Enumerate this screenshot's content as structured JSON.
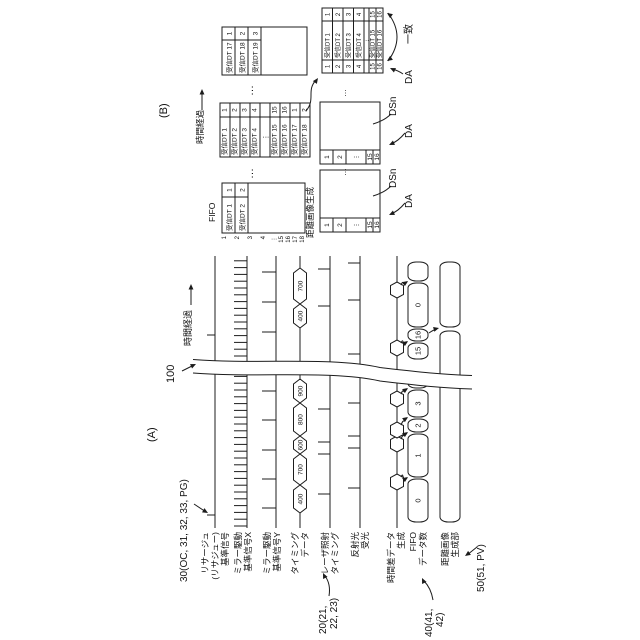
{
  "figure": {
    "label_a": "(A)",
    "label_b": "(B)",
    "ref_100": "100",
    "ref_30": "30(OC, 31, 32, 33, PG)",
    "ref_20_l1": "20(21,",
    "ref_20_l2": "22, 23)",
    "ref_40_l1": "40(41,",
    "ref_40_l2": "42)",
    "ref_50": "50(51, PV)",
    "time_elapsed_a": "時間経過",
    "time_elapsed_b": "時間経過"
  },
  "signal_labels": {
    "rows": [
      {
        "id": "lissajous",
        "lines": [
          "リサージュ",
          "(リサジュー)",
          "基準信号"
        ]
      },
      {
        "id": "mirror-x",
        "lines": [
          "ミラー駆動",
          "基準信号X"
        ]
      },
      {
        "id": "mirror-y",
        "lines": [
          "ミラー駆動",
          "基準信号Y"
        ]
      },
      {
        "id": "timing-data",
        "lines": [
          "タイミング",
          "データ"
        ]
      },
      {
        "id": "laser",
        "lines": [
          "レーザ照射",
          "タイミング"
        ]
      },
      {
        "id": "reflect",
        "lines": [
          "反射光",
          "受光"
        ]
      },
      {
        "id": "diff-gen",
        "lines": [
          "時間差データ",
          "生成"
        ]
      },
      {
        "id": "fifo-count",
        "lines": [
          "FIFO",
          "データ数"
        ]
      },
      {
        "id": "range-image",
        "lines": [
          "距離画像",
          "生成部"
        ]
      }
    ]
  },
  "waveforms": {
    "x_start": 112,
    "x_end": 384,
    "lissajous_y": 215,
    "lissajous_ticks": [
      125,
      305
    ],
    "mirror_x_y": 247,
    "mirror_x_comb": {
      "from": 114,
      "to": 383,
      "step": 6.8,
      "h": 13
    },
    "mirror_y_y": 276,
    "mirror_y_ticks": [
      132,
      161,
      190,
      220,
      249,
      308,
      338,
      368
    ],
    "timing_y": 300,
    "timing_chains": [
      {
        "cells": [
          {
            "v": "400",
            "x1": 127,
            "x2": 155
          },
          {
            "v": "700",
            "x1": 155,
            "x2": 186
          },
          {
            "v": "600",
            "x1": 186,
            "x2": 204
          },
          {
            "v": "800",
            "x1": 204,
            "x2": 237
          },
          {
            "v": "900",
            "x1": 237,
            "x2": 261
          }
        ]
      },
      {
        "cells": [
          {
            "v": "400",
            "x1": 312,
            "x2": 336
          },
          {
            "v": "700",
            "x1": 336,
            "x2": 372
          }
        ]
      }
    ],
    "laser_y": 330,
    "laser_ticks": [
      146,
      186,
      198,
      231,
      334,
      371
    ],
    "reflect_y": 360,
    "reflect_ticks": [
      152,
      192,
      204,
      237,
      286,
      340,
      377
    ],
    "diff_y": 397,
    "hexagon_marks": [
      158,
      196,
      210,
      241,
      292,
      350
    ],
    "fifo_bar": {
      "y1": 408,
      "y2": 428,
      "segments": [
        {
          "x1": 118,
          "x2": 161,
          "v": "0"
        },
        {
          "x1": 163,
          "x2": 206,
          "v": "1"
        },
        {
          "x1": 208,
          "x2": 221,
          "v": "2"
        },
        {
          "x1": 223,
          "x2": 250,
          "v": "3"
        },
        {
          "x1": 252,
          "x2": 261,
          "v": ""
        },
        {
          "x1": 281,
          "x2": 297,
          "v": "15"
        },
        {
          "x1": 299,
          "x2": 311,
          "v": "16"
        },
        {
          "x1": 313,
          "x2": 357,
          "v": "0"
        },
        {
          "x1": 359,
          "x2": 378,
          "v": ""
        }
      ],
      "hex_arrow_targets": [
        163,
        208,
        223,
        252,
        299,
        359
      ],
      "flush_x": 311
    },
    "img_bar": {
      "y1": 440,
      "y2": 460,
      "segments": [
        {
          "x1": 118,
          "x2": 309
        },
        {
          "x1": 313,
          "x2": 378
        }
      ]
    },
    "break_band": {
      "x_top_left": 267,
      "x_bottom_left": 251,
      "width": 13.5,
      "y_top": 193,
      "y_bottom": 472
    }
  },
  "panelB": {
    "fifo_label": "FIFO",
    "range_gen_label": "距離画像生成",
    "dsn_label": "DSn",
    "da_label": "DA",
    "match_label": "一致",
    "dots_h": "…",
    "dots_v": "⋮",
    "t1": {
      "x": 407,
      "y": 222,
      "w": 50,
      "h": 83,
      "row_h": 13,
      "div": 36,
      "rows": [
        [
          "受信DT 1",
          "1"
        ],
        [
          "受信DT 2",
          "2"
        ]
      ],
      "indices": [
        [
          "1",
          224
        ],
        [
          "2",
          237
        ],
        [
          "3",
          250
        ],
        [
          "4",
          263
        ],
        [
          "⋮",
          274
        ],
        [
          "15",
          281
        ],
        [
          "16",
          288
        ],
        [
          "17",
          295
        ],
        [
          "18",
          302
        ]
      ]
    },
    "t2": {
      "x": 483,
      "y": 220,
      "w": 54,
      "h": 90,
      "row_h": 10,
      "div": 40,
      "rows": [
        [
          "受信DT 1",
          "1"
        ],
        [
          "受信DT 2",
          "2"
        ],
        [
          "受信DT 3",
          "3"
        ],
        [
          "受信DT 4",
          "4"
        ],
        [
          "⋮",
          ""
        ],
        [
          "受信DT 15",
          "15"
        ],
        [
          "受信DT 16",
          "16"
        ],
        [
          "受信DT 17",
          "1"
        ],
        [
          "受信DT 18",
          "2"
        ]
      ]
    },
    "t3": {
      "x": 565,
      "y": 222,
      "w": 48,
      "h": 85,
      "row_h": 13,
      "div": 35,
      "rows": [
        [
          "受信DT 17",
          "1"
        ],
        [
          "受信DT 18",
          "2"
        ],
        [
          "受信DT 19",
          "3"
        ]
      ]
    },
    "b1": {
      "x": 408,
      "y": 320,
      "w": 62,
      "h": 60,
      "col_w": 14,
      "cells": [
        [
          "1",
          320,
          333
        ],
        [
          "2",
          333,
          346
        ],
        [
          "⋮",
          346,
          366
        ],
        [
          "15",
          366,
          373
        ],
        [
          "16",
          373,
          380
        ]
      ]
    },
    "b2": {
      "x": 476,
      "y": 320,
      "w": 62,
      "h": 60,
      "col_w": 14,
      "cells": [
        [
          "1",
          320,
          333
        ],
        [
          "2",
          333,
          346
        ],
        [
          "⋮",
          346,
          366
        ],
        [
          "15",
          366,
          373
        ],
        [
          "16",
          373,
          380
        ]
      ]
    },
    "b3": {
      "x": 567,
      "y": 322,
      "w": 65,
      "h": 61,
      "c1": 13,
      "c2": 39,
      "rows": [
        [
          "1",
          "受信DT 1",
          "1",
          322,
          332.5
        ],
        [
          "2",
          "受信DT 2",
          "2",
          332.5,
          343
        ],
        [
          "3",
          "受信DT 3",
          "3",
          343,
          353.5
        ],
        [
          "4",
          "受信DT 4",
          "4",
          353.5,
          364
        ],
        [
          "⋮",
          "",
          "",
          364,
          369
        ],
        [
          "15",
          "受信DT 15",
          "15",
          369,
          376
        ],
        [
          "16",
          "受信DT 16",
          "16",
          376,
          383
        ]
      ]
    }
  }
}
